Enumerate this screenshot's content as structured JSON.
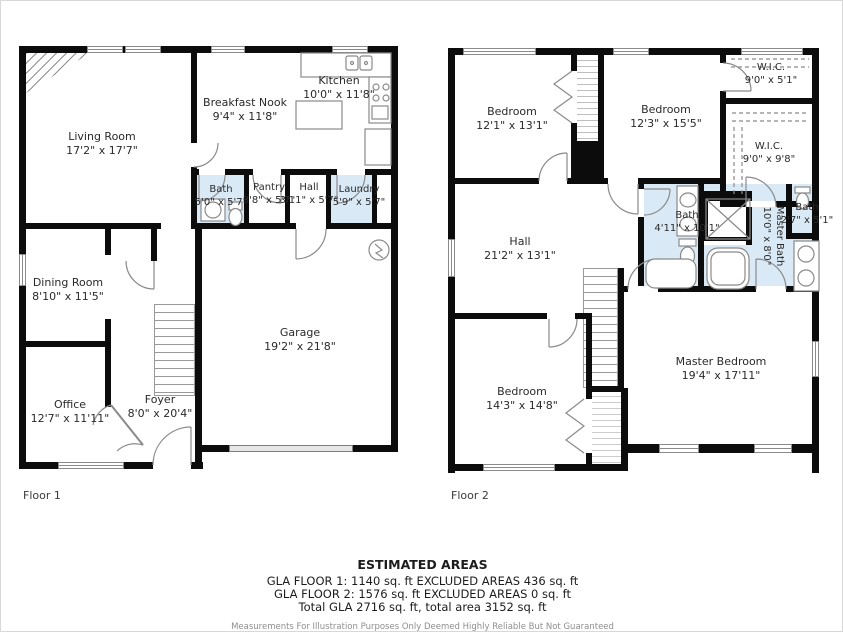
{
  "colors": {
    "wall": "#0c0c0c",
    "bath_fill": "#d9e9f6",
    "fixture_stroke": "#8a8a8a",
    "text": "#2a2a2a",
    "disclaimer_text": "#8e8e8e",
    "garage_door_fill": "#e6e6e6"
  },
  "floor1": {
    "label": "Floor 1",
    "rooms": {
      "living": {
        "name": "Living Room",
        "dims": "17'2\" x 17'7\""
      },
      "nook": {
        "name": "Breakfast Nook",
        "dims": "9'4\" x 11'8\""
      },
      "kitchen": {
        "name": "Kitchen",
        "dims": "10'0\" x 11'8\""
      },
      "bath": {
        "name": "Bath",
        "dims": "5'0\" x 5'7\""
      },
      "pantry": {
        "name": "Pantry",
        "dims": "3'8\" x 5'7\""
      },
      "hall": {
        "name": "Hall",
        "dims": "3'11\" x 5'7\""
      },
      "laundry": {
        "name": "Laundry",
        "dims": "5'9\" x 5'7\""
      },
      "dining": {
        "name": "Dining Room",
        "dims": "8'10\" x 11'5\""
      },
      "office": {
        "name": "Office",
        "dims": "12'7\" x 11'11\""
      },
      "foyer": {
        "name": "Foyer",
        "dims": "8'0\" x 20'4\""
      },
      "garage": {
        "name": "Garage",
        "dims": "19'2\" x 21'8\""
      }
    }
  },
  "floor2": {
    "label": "Floor 2",
    "rooms": {
      "bedroom1": {
        "name": "Bedroom",
        "dims": "12'1\" x 13'1\""
      },
      "bedroom2": {
        "name": "Bedroom",
        "dims": "12'3\" x 15'5\""
      },
      "wic1": {
        "name": "W.I.C.",
        "dims": "9'0\" x 5'1\""
      },
      "wic2": {
        "name": "W.I.C.",
        "dims": "9'0\" x 9'8\""
      },
      "bath1": {
        "name": "Bath",
        "dims": "4'11\" x 10'1\""
      },
      "masterbath": {
        "name": "Master Bath",
        "dims": "10'0\" x 8'0\""
      },
      "bath2": {
        "name": "Bath",
        "dims": "2'7\" x 5'1\""
      },
      "hall": {
        "name": "Hall",
        "dims": "21'2\" x 13'1\""
      },
      "bedroom3": {
        "name": "Bedroom",
        "dims": "14'3\" x 14'8\""
      },
      "master": {
        "name": "Master Bedroom",
        "dims": "19'4\" x 17'11\""
      }
    }
  },
  "summary": {
    "title": "ESTIMATED AREAS",
    "line1": "GLA FLOOR 1: 1140 sq. ft EXCLUDED AREAS 436 sq. ft",
    "line2": "GLA FLOOR 2: 1576 sq. ft EXCLUDED AREAS 0 sq. ft",
    "line3": "Total GLA 2716 sq. ft, total area 3152 sq. ft",
    "disclaimer": "Measurements For Illustration Purposes Only Deemed Highly Reliable But Not Guaranteed"
  }
}
